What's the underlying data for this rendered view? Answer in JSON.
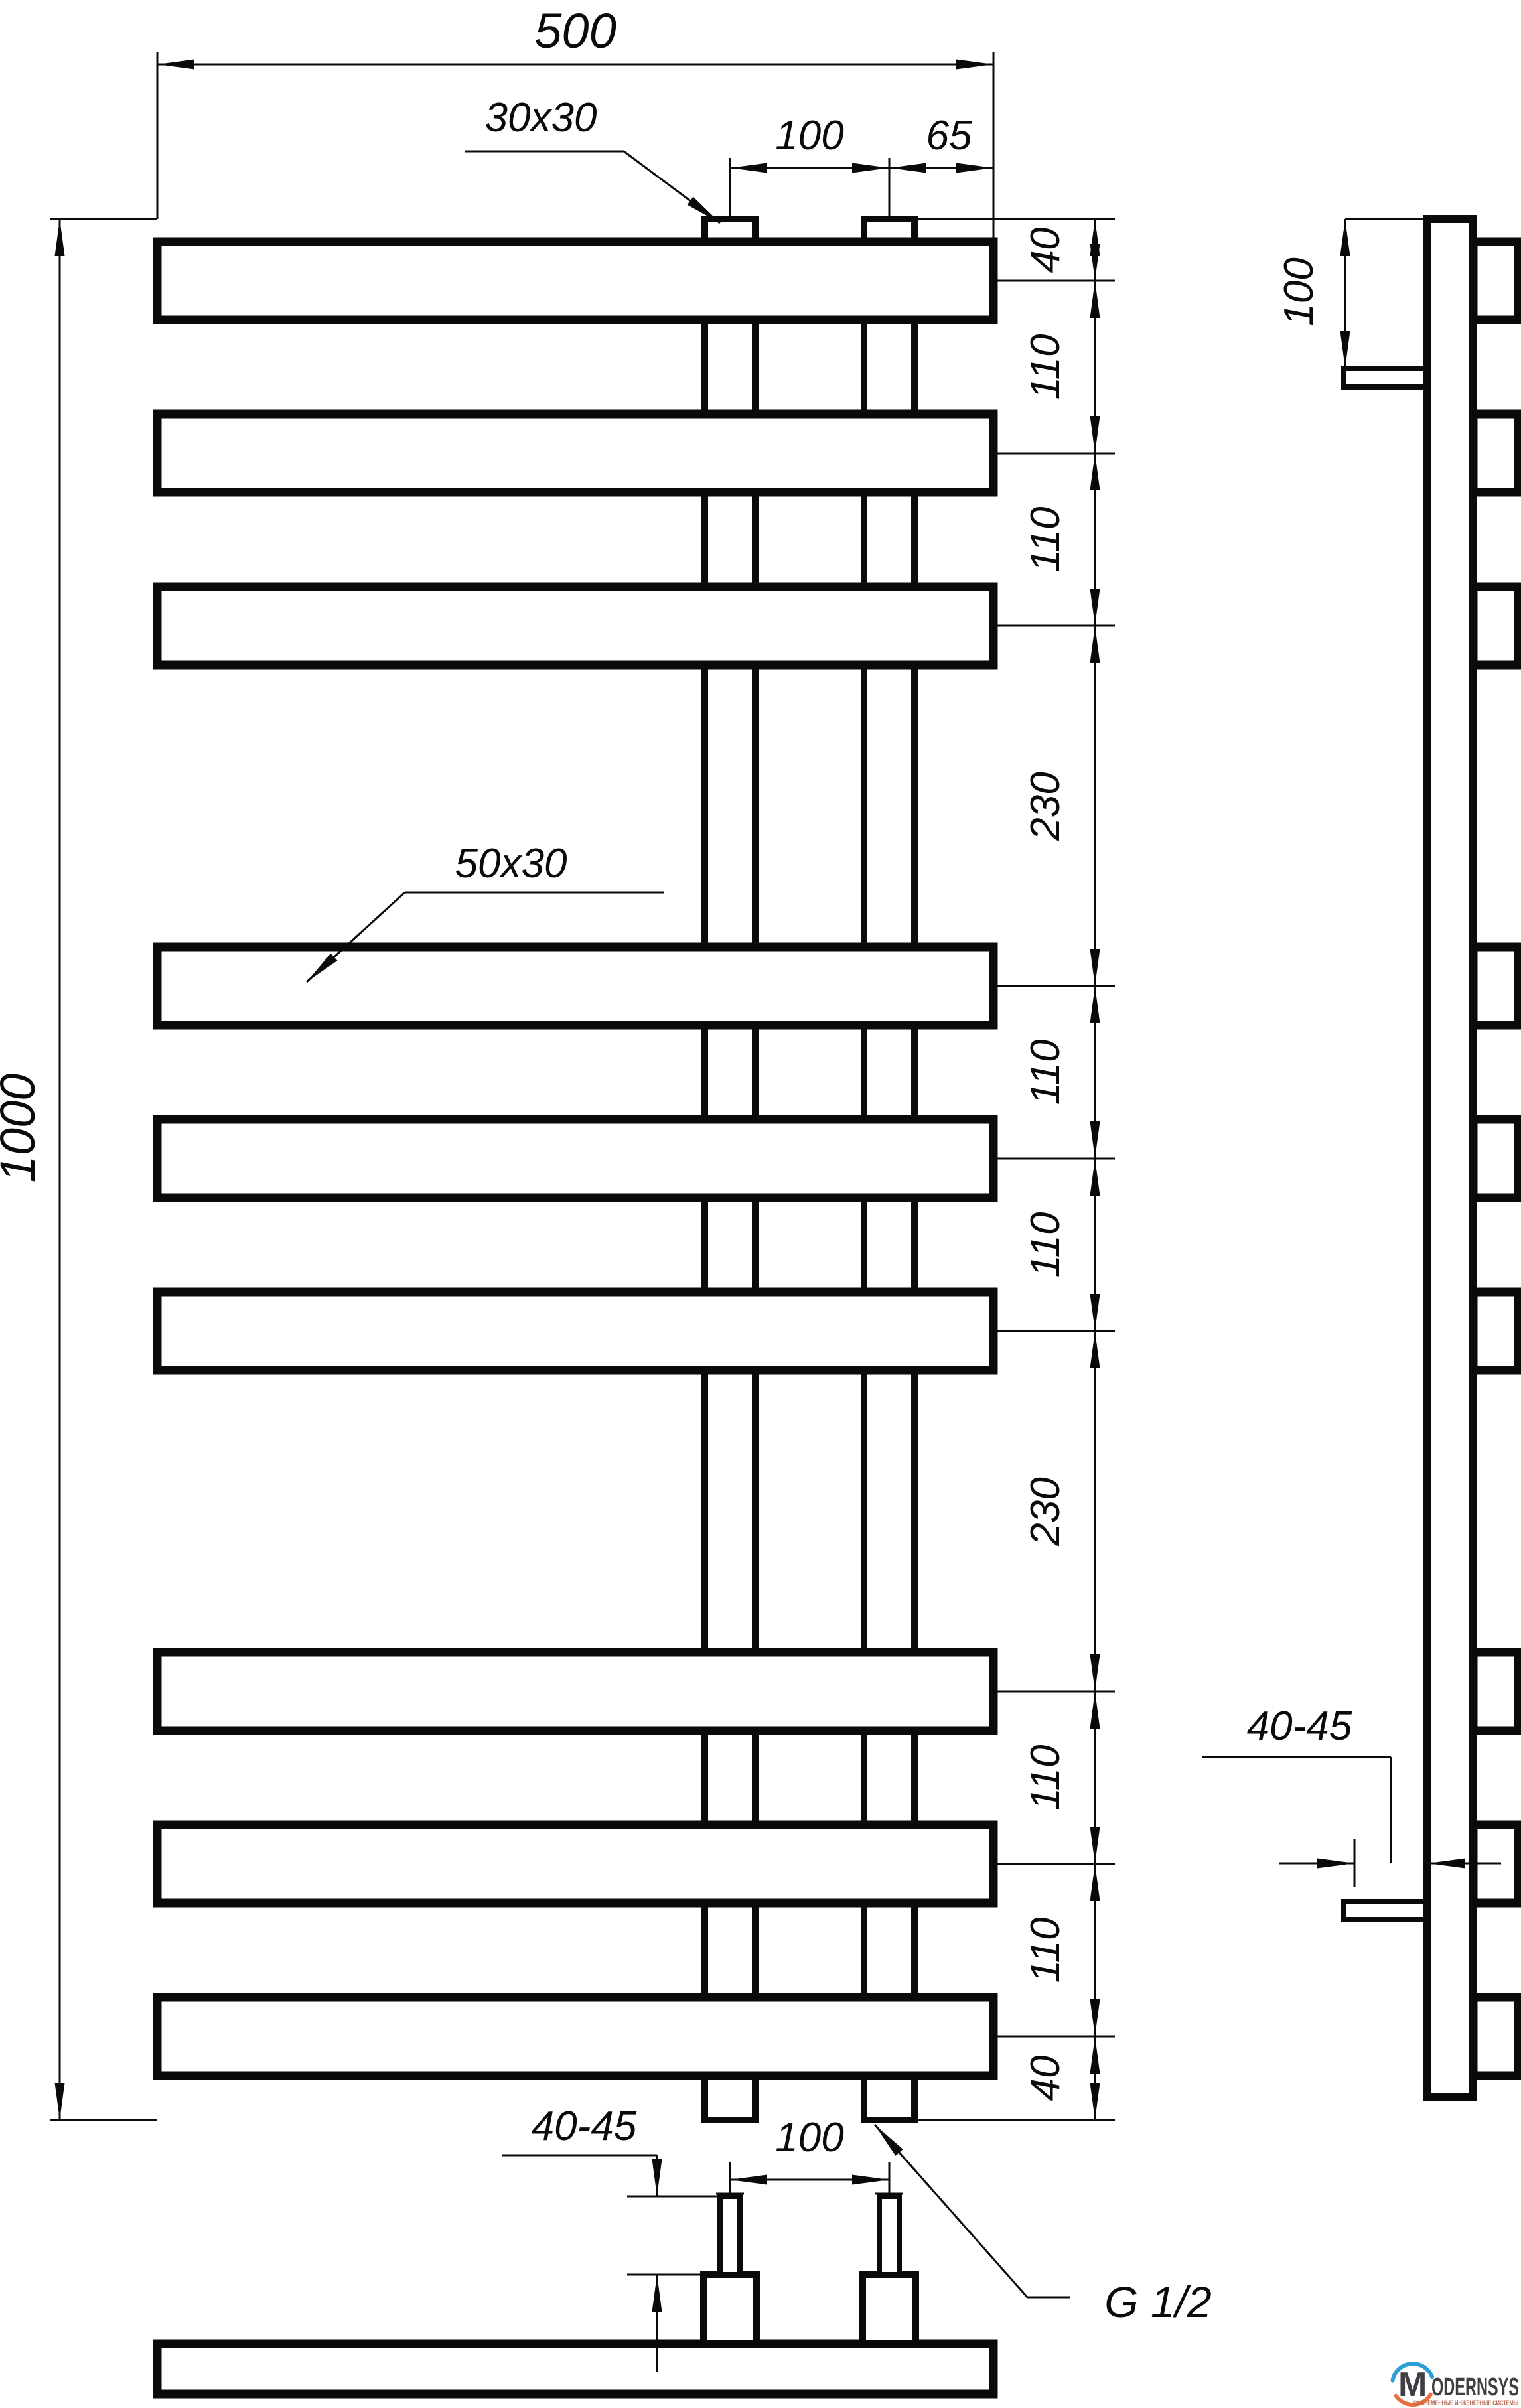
{
  "page": {
    "background": "#ffffff",
    "line_color": "#0a0a0a"
  },
  "front_view": {
    "dim_width": "500",
    "dim_height": "1000",
    "riser_profile_label": "30x30",
    "riser_spacing_label": "100",
    "riser_offset_label": "65",
    "bar_profile_label": "50x30",
    "spacing_chain": [
      "40",
      "110",
      "110",
      "230",
      "110",
      "110",
      "230",
      "110",
      "110",
      "40"
    ]
  },
  "side_view": {
    "top_offset_label": "100",
    "wall_clearance_label": "40-45"
  },
  "bottom_view": {
    "pipe_length_label": "40-45",
    "pipe_spacing_label": "100",
    "thread_label": "G 1/2"
  },
  "logo": {
    "monogram": "M",
    "name": "ODERNSYS",
    "tagline": "СОВРЕМЕННЫЕ ИНЖЕНЕРНЫЕ СИСТЕМЫ",
    "colors": {
      "arc_top": "#2d9fd4",
      "arc_bottom": "#e8703c",
      "name": "#3e3e43",
      "tagline": "#b56352"
    }
  }
}
